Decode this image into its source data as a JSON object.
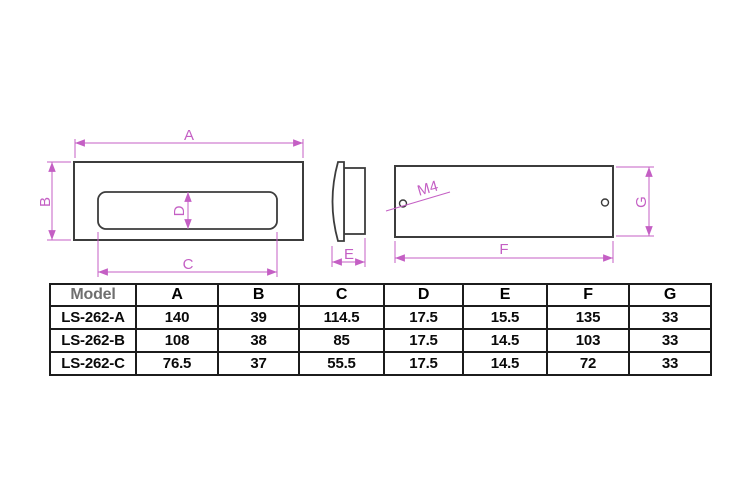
{
  "drawing": {
    "dim_labels": {
      "A": "A",
      "B": "B",
      "C": "C",
      "D": "D",
      "E": "E",
      "F": "F",
      "G": "G"
    },
    "thread_label": "M4",
    "dim_color": "#c45fc4",
    "line_color": "#3c3c3c"
  },
  "table": {
    "headers": [
      "Model",
      "A",
      "B",
      "C",
      "D",
      "E",
      "F",
      "G"
    ],
    "rows": [
      [
        "LS-262-A",
        "140",
        "39",
        "114.5",
        "17.5",
        "15.5",
        "135",
        "33"
      ],
      [
        "LS-262-B",
        "108",
        "38",
        "85",
        "17.5",
        "14.5",
        "103",
        "33"
      ],
      [
        "LS-262-C",
        "76.5",
        "37",
        "55.5",
        "17.5",
        "14.5",
        "72",
        "33"
      ]
    ]
  }
}
